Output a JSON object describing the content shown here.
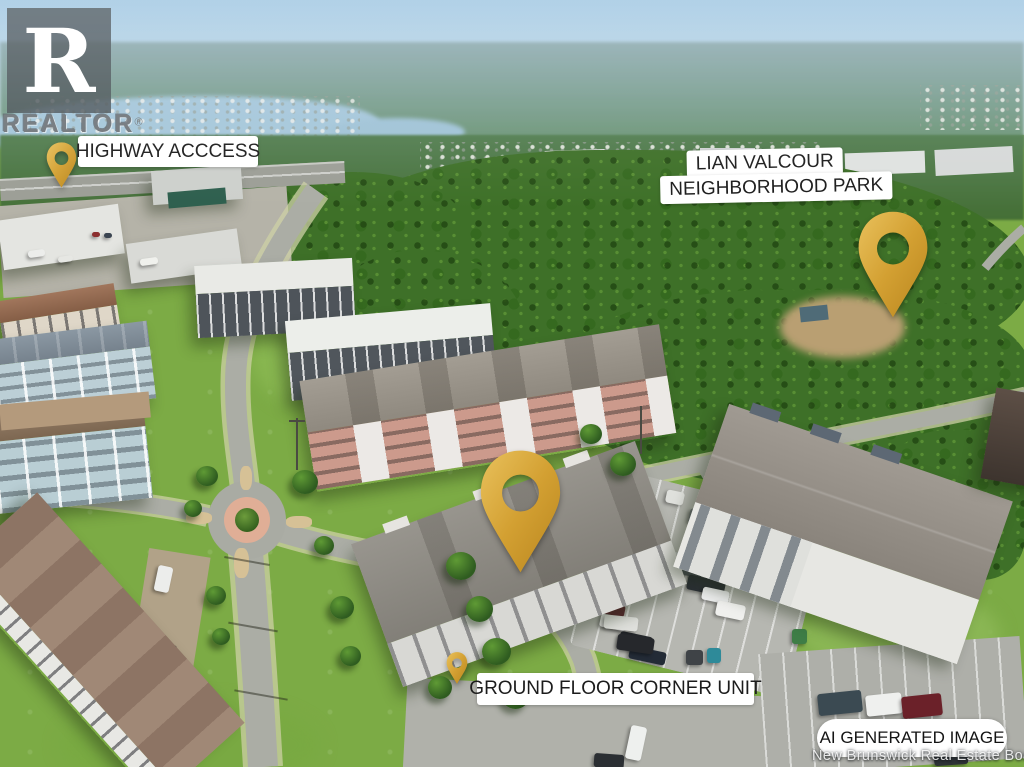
{
  "watermarks": {
    "realtor": {
      "letter": "R",
      "wordmark": "REALTOR",
      "registered": "®"
    },
    "board": "New Brunswick Real Estate Board"
  },
  "callouts": {
    "highway": {
      "label": "HIGHWAY ACCCESS"
    },
    "park": {
      "line1": "LIAN VALCOUR",
      "line2": "NEIGHBORHOOD PARK"
    },
    "unit": {
      "label": "GROUND FLOOR CORNER UNIT"
    },
    "badge": {
      "label": "AI GENERATED IMAGE"
    }
  },
  "pins": {
    "icon": "map-pin-icon",
    "count": 4,
    "color_top": "#E7BD55",
    "color_bottom": "#B9861F"
  },
  "colors": {
    "label_background": "#FFFFFF",
    "label_text": "#1C1C1C",
    "pin_gold": "#D4A238",
    "sky": "#A9CDE4",
    "forest": "#3E7028",
    "grass": "#7CAB45",
    "road": "#ABADA5"
  }
}
